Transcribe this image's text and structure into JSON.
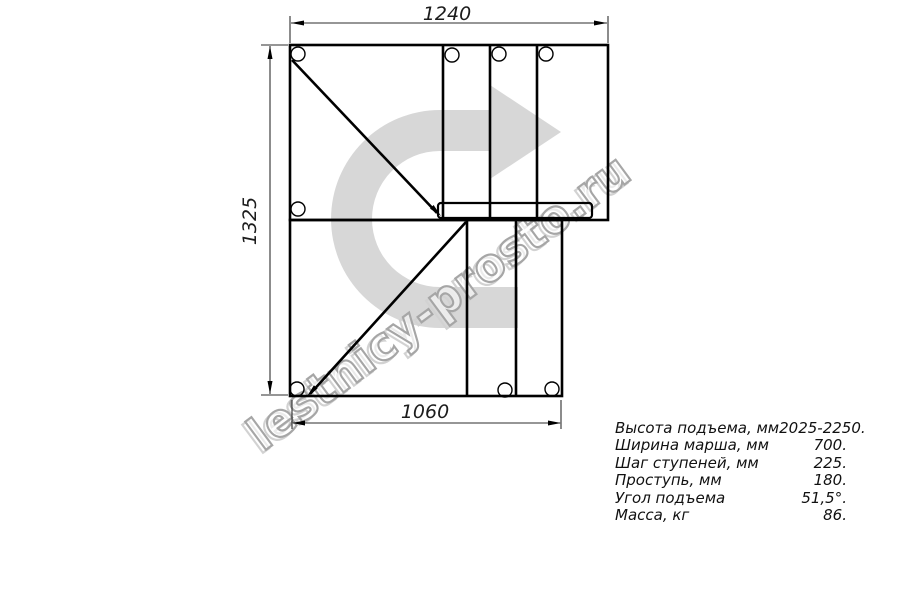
{
  "drawing": {
    "type": "staircase top-view plan, quarter-turn right",
    "dim_top": "1240",
    "dim_left": "1325",
    "dim_bottom": "1060"
  },
  "watermark": {
    "text": "lestnicy-prosto.ru",
    "arrow_color": "#d7d7d7",
    "outline_color": "#a6a6a6"
  },
  "specs": [
    {
      "label": "Высота подъема, мм",
      "value": "2025-2250."
    },
    {
      "label": "Ширина марша, мм",
      "value": "700."
    },
    {
      "label": "Шаг ступеней, мм",
      "value": "225."
    },
    {
      "label": "Проступь, мм",
      "value": "180."
    },
    {
      "label": "Угол подъема",
      "value": "51,5°."
    },
    {
      "label": "Масса, кг",
      "value": "86."
    }
  ],
  "colors": {
    "line": "#000000",
    "dimension": "#2e2e2e",
    "background": "#ffffff"
  }
}
